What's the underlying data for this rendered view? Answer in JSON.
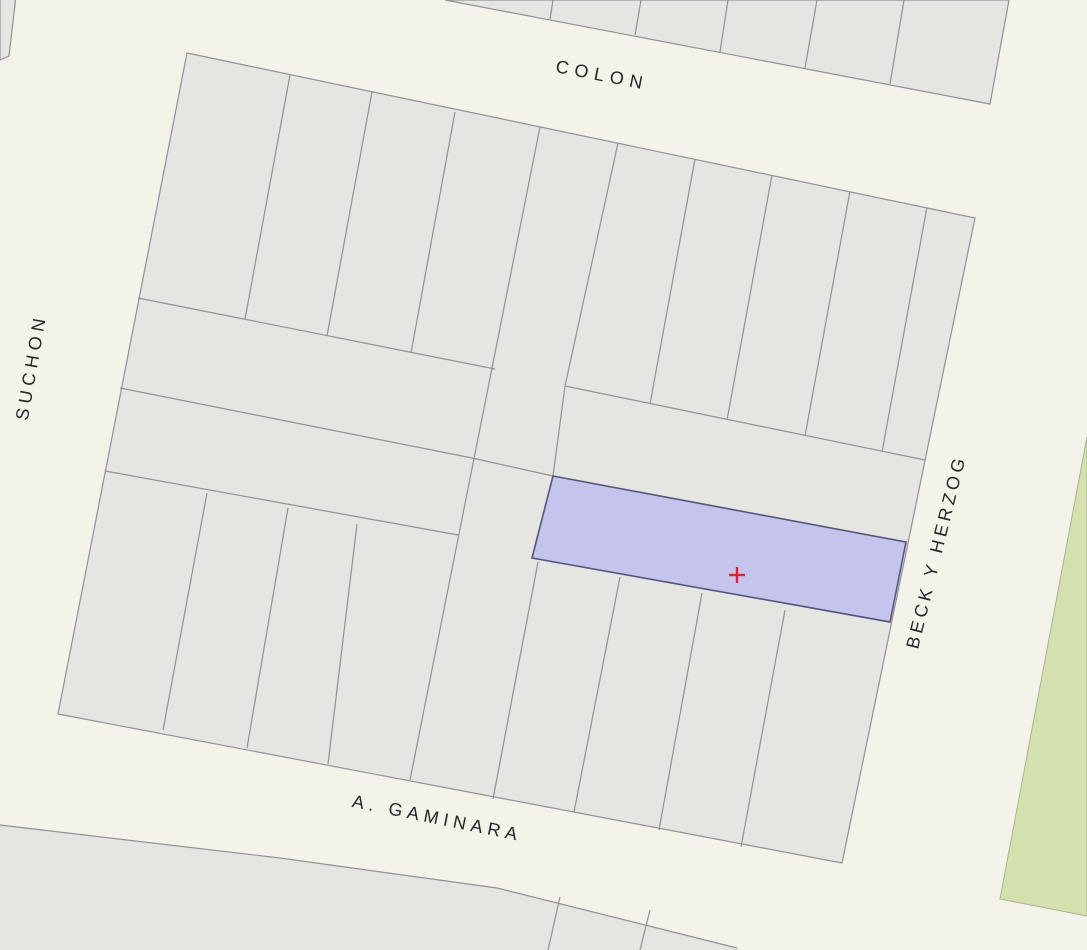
{
  "map": {
    "type": "cadastral-parcel-map",
    "streets": [
      {
        "id": "colon",
        "label": "COLON",
        "x": 601,
        "y": 81,
        "rotation": 11,
        "letter_spacing": 6
      },
      {
        "id": "suchon",
        "label": "SUCHON",
        "x": 37,
        "y": 368,
        "rotation": -80,
        "letter_spacing": 5
      },
      {
        "id": "beck-y-herzog",
        "label": "BECK Y HERZOG",
        "x": 942,
        "y": 553,
        "rotation": -76,
        "letter_spacing": 4
      },
      {
        "id": "a-gaminara",
        "label": "A. GAMINARA",
        "x": 436,
        "y": 824,
        "rotation": 11.5,
        "letter_spacing": 5
      }
    ],
    "selected_parcel": {
      "marker_x": 737,
      "marker_y": 575,
      "marker_arm": 8
    },
    "colors": {
      "street_background": "#f4f3ea",
      "parcel_fill": "#e5e5e1",
      "parcel_border": "#919197",
      "selected_parcel_fill": "#c5c4ed",
      "selected_parcel_border": "#55557d",
      "marker_red": "#ea1c2c",
      "green_area_fill": "#d4e0ad",
      "green_area_border": "#abb294",
      "label_color": "#262626"
    }
  }
}
